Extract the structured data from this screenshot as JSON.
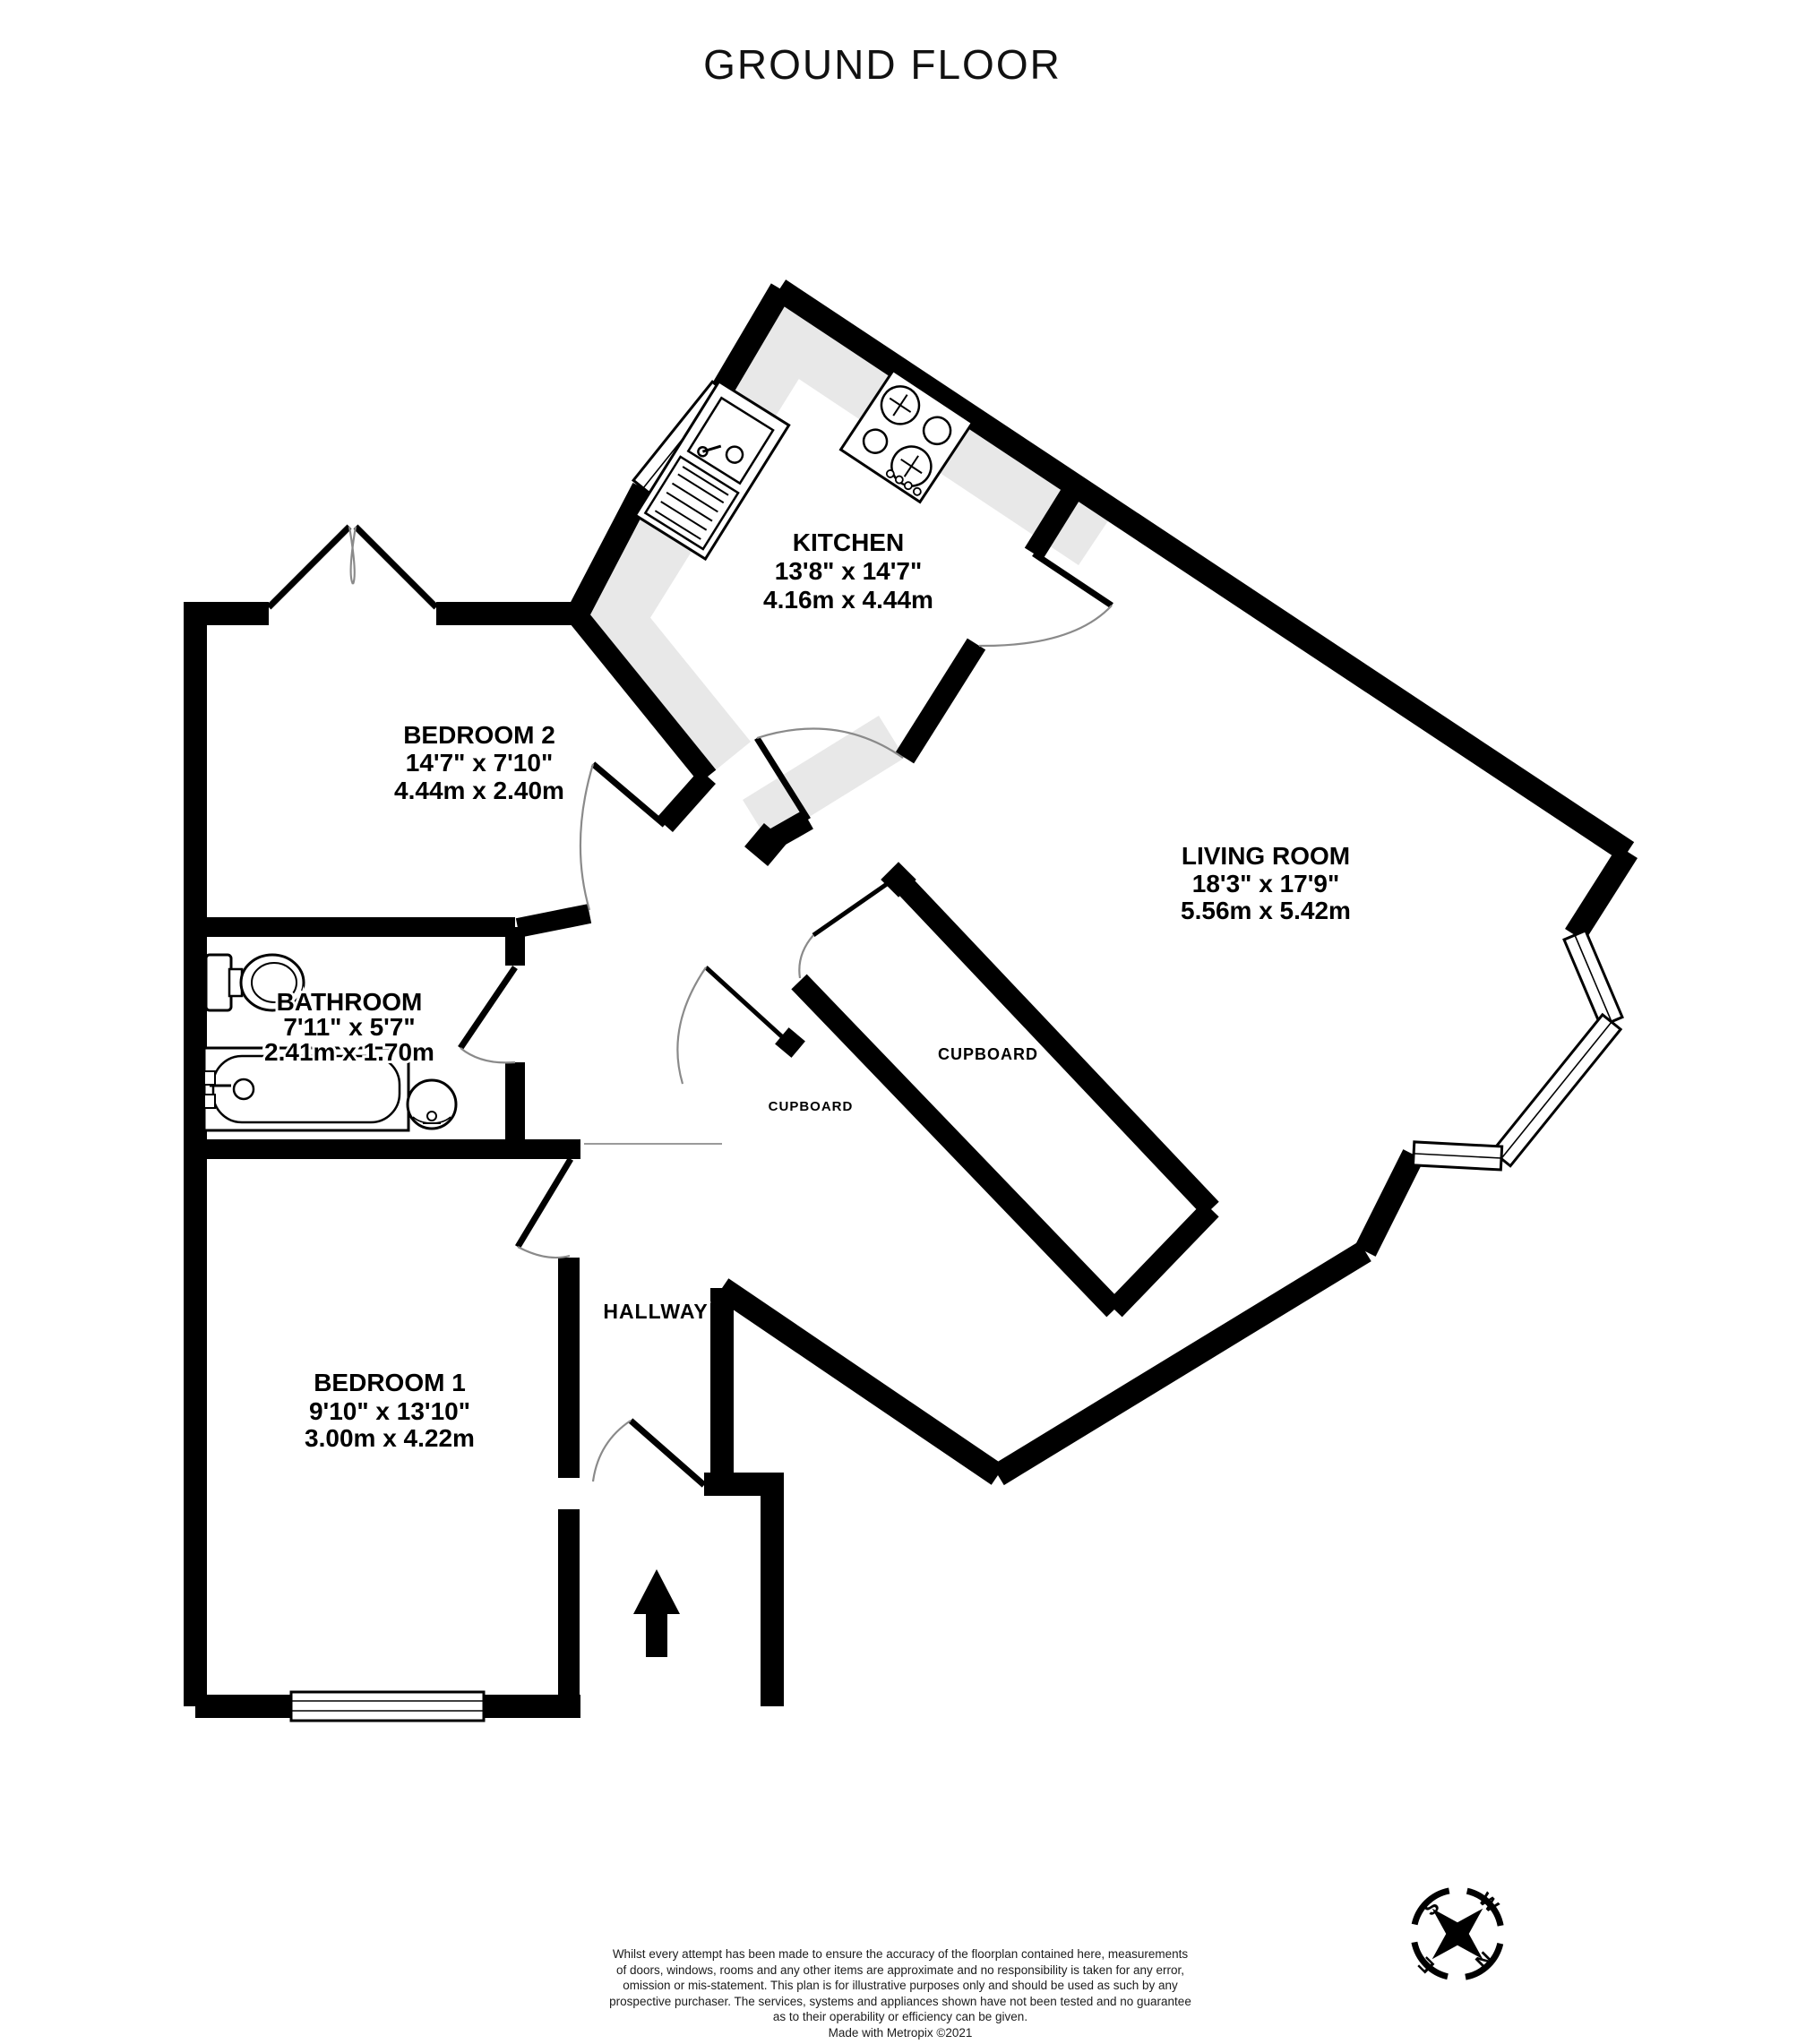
{
  "title": "GROUND FLOOR",
  "rooms": {
    "kitchen": {
      "name": "KITCHEN",
      "imperial": "13'8\" x 14'7\"",
      "metric": "4.16m x 4.44m"
    },
    "bedroom2": {
      "name": "BEDROOM 2",
      "imperial": "14'7\" x 7'10\"",
      "metric": "4.44m x 2.40m"
    },
    "living": {
      "name": "LIVING ROOM",
      "imperial": "18'3\" x 17'9\"",
      "metric": "5.56m x 5.42m"
    },
    "bathroom": {
      "name": "BATHROOM",
      "imperial": "7'11\" x 5'7\"",
      "metric": "2.41m x 1.70m"
    },
    "bedroom1": {
      "name": "BEDROOM 1",
      "imperial": "9'10\" x 13'10\"",
      "metric": "3.00m x 4.22m"
    },
    "hallway": {
      "name": "HALLWAY"
    },
    "cupboard_living": {
      "name": "CUPBOARD"
    },
    "cupboard_hall": {
      "name": "CUPBOARD"
    }
  },
  "compass": {
    "n": "N",
    "e": "E",
    "s": "S",
    "w": "W"
  },
  "footer": {
    "line1": "Whilst every attempt has been made to ensure the accuracy of the floorplan contained here, measurements",
    "line2": "of doors, windows, rooms and any other items are approximate and no responsibility is taken for any error,",
    "line3": "omission or mis-statement. This plan is for illustrative purposes only and should be used as such by any",
    "line4": "prospective purchaser. The services, systems and appliances shown have not been tested and no guarantee",
    "line5": "as to their operability or efficiency can be given.",
    "credit": "Made with Metropix ©2021"
  }
}
